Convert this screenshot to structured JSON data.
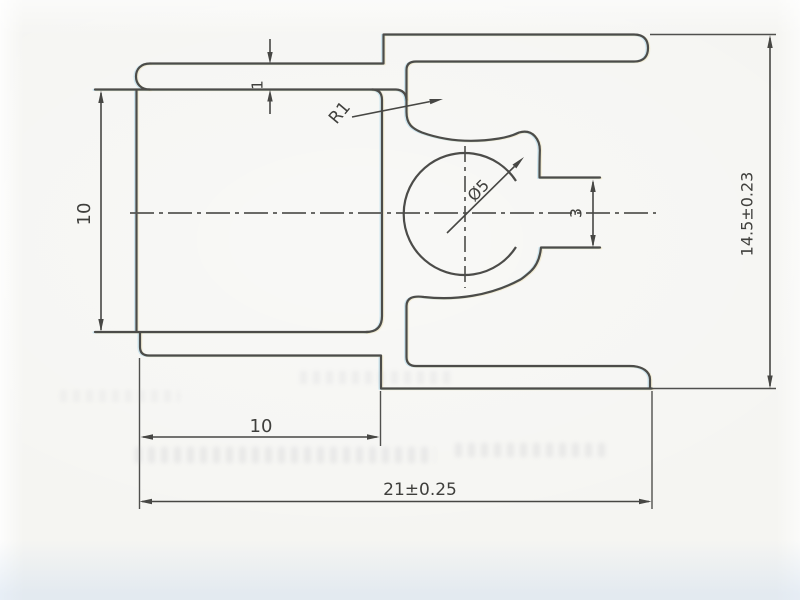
{
  "drawing": {
    "type": "technical-profile-cross-section",
    "paper_color": "#f5f5f2",
    "line_color": "#4a4a47",
    "text_color": "#3d3d3a",
    "dimensions": {
      "flange_thickness": {
        "label": "1",
        "orientation": "vertical"
      },
      "corner_radius_callout": {
        "label": "R1",
        "orientation": "diagonal"
      },
      "left_channel_height": {
        "label": "10",
        "orientation": "vertical"
      },
      "bead_diameter_callout": {
        "label": "Ø5",
        "orientation": "diagonal"
      },
      "slot_height": {
        "label": "3",
        "orientation": "vertical"
      },
      "overall_height": {
        "label": "14.5±0.23",
        "orientation": "vertical"
      },
      "bottom_flange_width": {
        "label": "10",
        "orientation": "horizontal"
      },
      "overall_width": {
        "label": "21±0.25",
        "orientation": "horizontal"
      }
    }
  }
}
